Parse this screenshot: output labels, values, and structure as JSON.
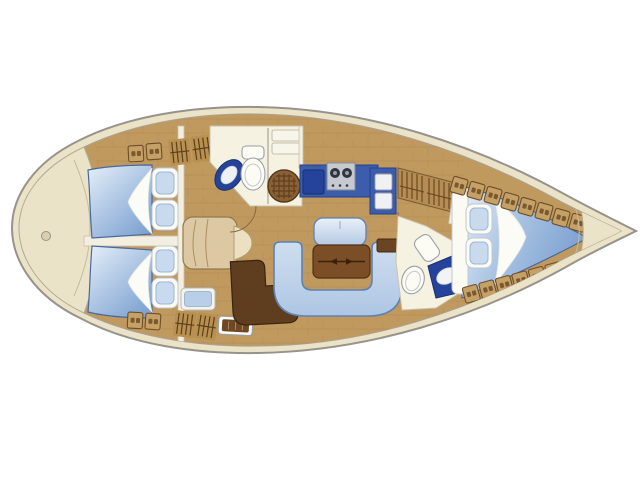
{
  "diagram": {
    "type": "sailing-yacht-interior-floorplan",
    "orientation": {
      "bow": "right",
      "stern": "left"
    },
    "palette": {
      "bg": "#ffffff",
      "hull_band": "#ebe3c8",
      "hull_stroke": "#97938b",
      "deck_wood": "#c0995f",
      "wood_seam": "#a8834e",
      "room_cream": "#f6f2e2",
      "wall_fill": "#f2eee0",
      "wall_stroke": "#c9c2ae",
      "locker_tan": "#c6a166",
      "locker_stroke": "#6d4e2b",
      "berth_light": "#e6eff9",
      "berth_deep": "#7fa3d2",
      "berth_stroke": "#47699f",
      "sofa_fill": "#c3d5ea",
      "sofa_stroke": "#5d82b4",
      "counter_blue": "#3c5dab",
      "counter_navy": "#26439b",
      "stove_gray": "#c6cad0",
      "table_brown": "#7c4e28",
      "nav_brown": "#5f3d1f",
      "fixture_white": "#fcfbf4",
      "fixture_stroke": "#9aa0a8",
      "grate_brown": "#8a6134",
      "steps_tan": "#dcc9a4"
    },
    "areas": [
      {
        "id": "stern-deck",
        "kind": "deck"
      },
      {
        "id": "aft-cabin-port",
        "kind": "cabin",
        "features": [
          "double-berth",
          "two-pillows",
          "lockers",
          "hatch-grates"
        ]
      },
      {
        "id": "aft-cabin-starboard",
        "kind": "cabin",
        "features": [
          "double-berth",
          "two-pillows",
          "lockers",
          "hatch-grates"
        ]
      },
      {
        "id": "companionway",
        "kind": "passage",
        "features": [
          "steps"
        ]
      },
      {
        "id": "aft-head",
        "kind": "bathroom",
        "features": [
          "sink",
          "toilet",
          "shower-grate",
          "shelves"
        ]
      },
      {
        "id": "galley",
        "kind": "kitchen",
        "features": [
          "sink",
          "two-burner-stove",
          "refrigerator",
          "louvered-cabinet"
        ]
      },
      {
        "id": "salon",
        "kind": "saloon",
        "features": [
          "u-shaped-sofa",
          "folding-table",
          "bench-seat",
          "side-cabinet"
        ]
      },
      {
        "id": "nav-station",
        "kind": "navigation",
        "features": [
          "chart-seat",
          "deck-hatch",
          "blue-shelves"
        ]
      },
      {
        "id": "forward-head",
        "kind": "bathroom",
        "features": [
          "toilet",
          "sink",
          "counter"
        ]
      },
      {
        "id": "forward-cabin",
        "kind": "cabin",
        "features": [
          "v-berth",
          "two-pillows",
          "side-shelf-lockers"
        ]
      },
      {
        "id": "bow-deck",
        "kind": "deck",
        "features": [
          "anchor-well"
        ]
      }
    ]
  }
}
